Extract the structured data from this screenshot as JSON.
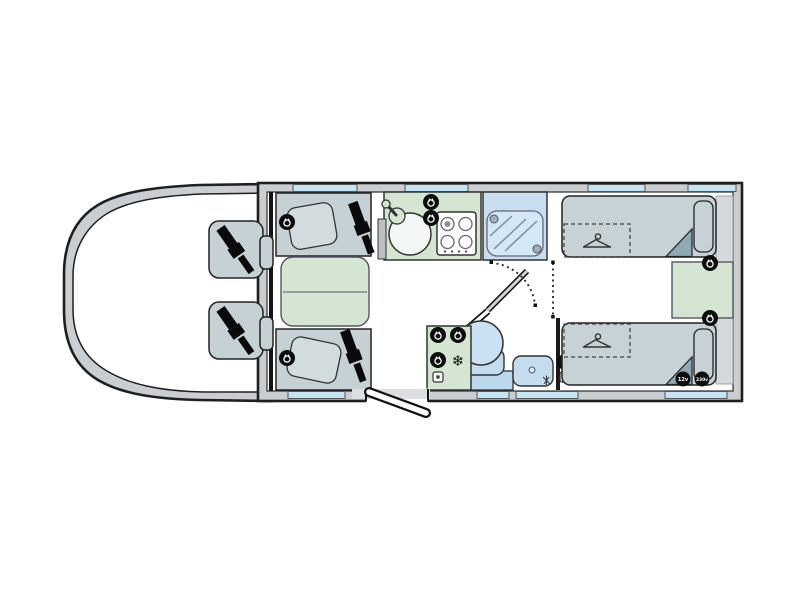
{
  "labels": {
    "socket_12v": "12v",
    "socket_230v": "230v",
    "snowflake_glyph": "❄"
  },
  "colors": {
    "outline": "#1f1f1f",
    "wall_fill": "#c9ced2",
    "floor": "#ffffff",
    "furniture_grey_blue": "#c6d1d5",
    "bed_grey_blue": "#c7d2d6",
    "cabinet_green": "#d4e6d1",
    "window_blue": "#c4e3f3",
    "shower_blue": "#c9ddf1",
    "fixture_blue": "#c3ddef",
    "duvet_fold_teal": "#8ea9b4",
    "badge_black": "#0d0d0d"
  },
  "icons": [
    "seatbelt-icon",
    "mains-socket-icon",
    "socket-outlet-icon",
    "snowflake-icon",
    "coat-hanger-icon",
    "shower-head-icon",
    "hob-burner-icon",
    "sink-tap-icon"
  ],
  "components": [
    "cab-seat-driver",
    "cab-seat-passenger",
    "lounge-bench-front",
    "lounge-bench-rear",
    "lounge-table",
    "kitchen-worktop",
    "kitchen-sink",
    "kitchen-hob-4-burner",
    "shower-cubicle",
    "washroom-door",
    "toilet",
    "washbasin",
    "fridge-freezer-cabinet",
    "single-bed-offside",
    "single-bed-nearside",
    "under-bed-wardrobe-offside",
    "under-bed-wardrobe-nearside",
    "between-bed-chest",
    "entry-door",
    "windows"
  ]
}
